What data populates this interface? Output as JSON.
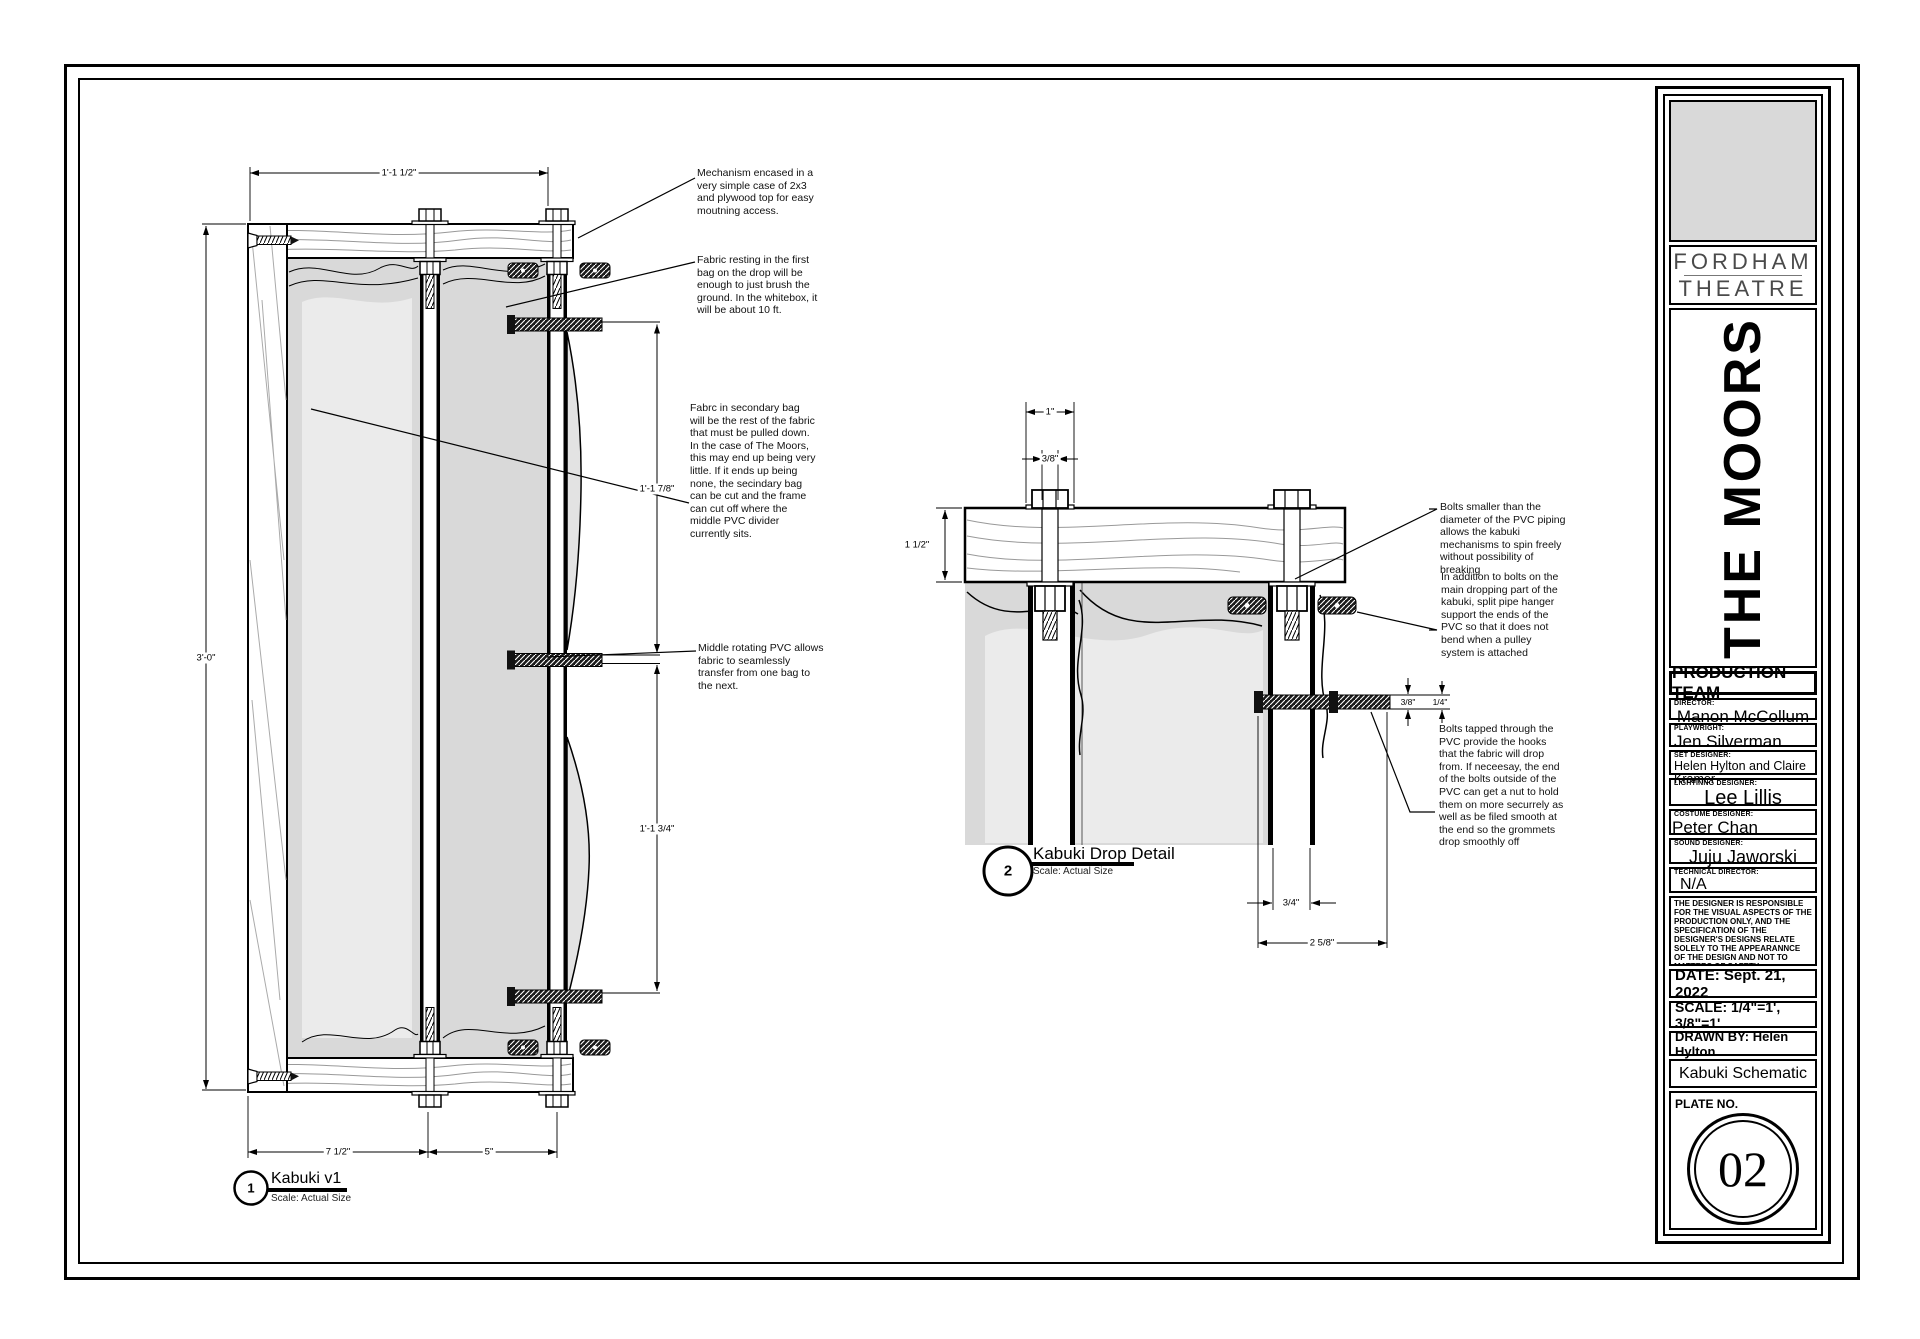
{
  "drawing1": {
    "callout": {
      "number": "1",
      "title": "Kabuki v1",
      "scale": "Scale: Actual Size"
    },
    "annotations": [
      {
        "text": "Mechanism encased in a\nvery simple case of 2x3\nand plywood top for easy\nmoutning access."
      },
      {
        "text": "Fabric resting in the first\nbag on the drop will be\nenough to just brush the\nground. In the whitebox, it\nwill be about 10 ft."
      },
      {
        "text": "Fabrc in secondary bag\nwill be the rest of the fabric\nthat must be pulled down.\nIn the case of The Moors,\nthis may end up being very\nlittle. If it ends up being\nnone, the secindary bag\ncan be cut and the frame\ncan cut off where the\nmiddle PVC divider\ncurrently sits."
      },
      {
        "text": "Middle rotating PVC allows\nfabric to seamlessly\ntransfer from one bag to\nthe next."
      }
    ],
    "dims": {
      "top": "1'-1 1/2\"",
      "left": "3'-0\"",
      "right_upper": "1'-1 7/8\"",
      "right_lower": "1'-1 3/4\"",
      "bottom_left": "7 1/2\"",
      "bottom_right": "5\""
    }
  },
  "drawing2": {
    "callout": {
      "number": "2",
      "title": "Kabuki Drop Detail",
      "scale": "Scale: Actual Size"
    },
    "annotations": [
      {
        "text": "Bolts smaller than the\ndiameter of the PVC piping\nallows the kabuki\nmechanisms to spin freely\nwithout possibility of\nbreaking"
      },
      {
        "text": "In addition to bolts on the\nmain dropping part of the\nkabuki, split pipe hanger\nsupport the ends of the\nPVC so that it does not\nbend when a pulley\nsystem is attached"
      },
      {
        "text": "Bolts tapped through the\nPVC provide the hooks\nthat the fabric will drop\nfrom. If neceesay, the end\nof the bolts outside of the\nPVC can get a nut to hold\nthem on more securrely as\nwell as be filed smooth at\nthe end so the grommets\ndrop smoothly off"
      }
    ],
    "dims": {
      "head_width": "1\"",
      "bolt_width": "3/8\"",
      "wood_thickness": "1 1/2\"",
      "bolt_upper": "3/8\"",
      "bolt_lower": "1/4\"",
      "pipe_gap": "3/4\"",
      "overall": "2 5/8\""
    }
  },
  "title_block": {
    "logo": {
      "line1": "FORDHAM",
      "line2": "THEATRE"
    },
    "show_title": "THE MOORS",
    "team_header": "PRODUCTION TEAM",
    "team": [
      {
        "role": "DIRECTOR:",
        "name": "Manon McCollum"
      },
      {
        "role": "PLAYWRIGHT:",
        "name": "Jen Silverman"
      },
      {
        "role": "SET DESIGNER:",
        "name": "Helen Hylton and Claire Kramer"
      },
      {
        "role": "LIGHTINNG DESIGNER:",
        "name": "Lee Lillis"
      },
      {
        "role": "COSTUME DESIGNER:",
        "name": "Peter Chan"
      },
      {
        "role": "SOUND DESIGNER:",
        "name": "Juju Jaworski"
      },
      {
        "role": "TECHNICAL DIRECTOR:",
        "name": "N/A"
      }
    ],
    "disclaimer": "THE DESIGNER IS RESPONSIBLE FOR THE VISUAL ASPECTS OF THE PRODUCTION ONLY, AND THE SPECIFICATION OF THE DESIGNER'S DESIGNS RELATE SOLELY TO THE APPEARANNCE OF THE DESIGN AND NOT TO MATTERS OF SAFETY.\nTHE DESIGNER AGREES TO MAKE PROMPT CORRECTING ALTERATIONS TO ANY SPECIFICATIONS FOUND TO BE INCOMPATIBLE WITH PROPER SAFETY PRECAUTIONS.",
    "date": "DATE: Sept. 21, 2022",
    "scale": "SCALE: 1/4\"=1', 3/8\"=1'",
    "drawn_by": "DRAWN BY: Helen Hylton",
    "sheet_title": "Kabuki Schematic",
    "plate_label": "PLATE NO.",
    "plate_number": "02"
  },
  "colors": {
    "fabric": "#d9d9d9",
    "fabric_light": "#ebebeb",
    "line": "#000000"
  }
}
